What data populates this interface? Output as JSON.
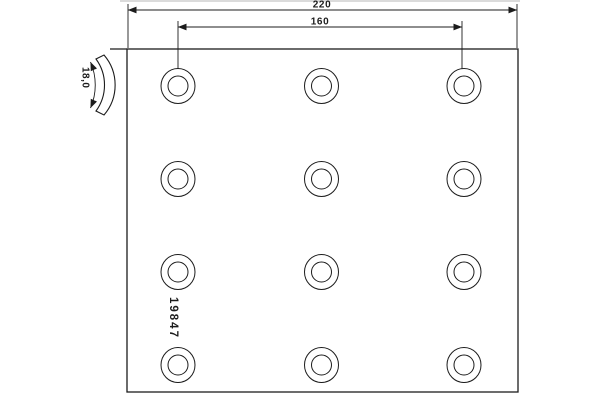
{
  "drawing": {
    "type": "brake-lining-technical-drawing",
    "part_number": "19847",
    "dimensions": {
      "overall_width": "220",
      "hole_spacing": "160",
      "thickness": "18,0"
    },
    "grid": {
      "columns": 3,
      "rows": 4,
      "hole_count": 12
    },
    "colors": {
      "line": "#1c1c1c",
      "background": "#ffffff"
    }
  }
}
